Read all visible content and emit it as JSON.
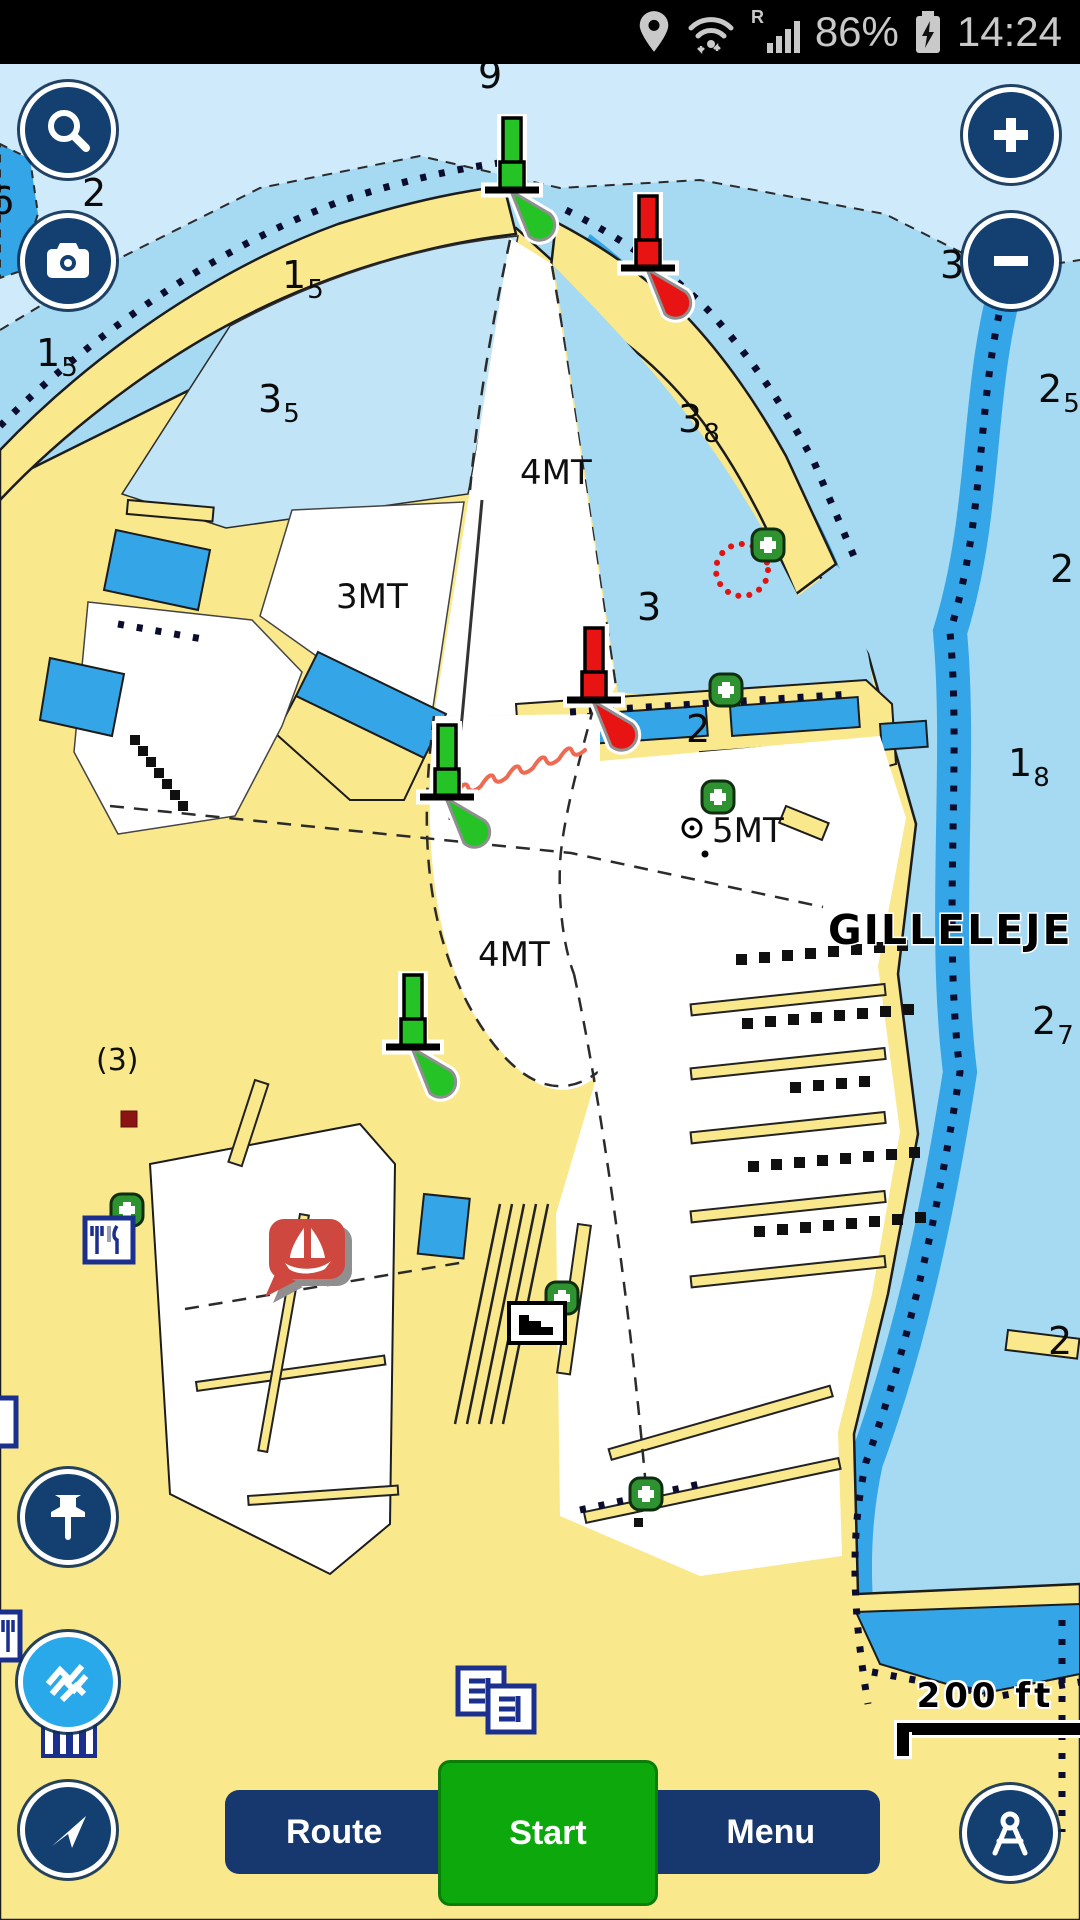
{
  "status_bar": {
    "time": "14:24",
    "battery": "86%",
    "roaming_badge": "R",
    "icons": {
      "location": "location-pin",
      "wifi": "wifi-arrows",
      "signal": "signal-bars",
      "battery": "battery-charging"
    }
  },
  "map_controls": {
    "icons": {
      "search": "magnifier",
      "camera": "camera",
      "zoom_in": "plus",
      "zoom_out": "minus",
      "drop_pin": "pushpin",
      "sonar_charts": "navionics-waves",
      "follow_me": "navigation-arrow",
      "distance_tool": "divider-compass"
    }
  },
  "bottom_bar": {
    "route_label": "Route",
    "start_label": "Start",
    "menu_label": "Menu"
  },
  "map": {
    "place_label": "GILLELEJE",
    "scale_label": "200 ft",
    "annotation": "(3)",
    "depth_area_labels": [
      {
        "text": "4MT",
        "x": 520,
        "y": 420
      },
      {
        "text": "3MT",
        "x": 336,
        "y": 544
      },
      {
        "text": "5MT",
        "x": 712,
        "y": 778
      },
      {
        "text": "4MT",
        "x": 478,
        "y": 902
      }
    ],
    "soundings": [
      {
        "main": "9",
        "sub": "",
        "x": 478,
        "y": 24
      },
      {
        "main": "6",
        "sub": "",
        "x": -10,
        "y": 150
      },
      {
        "main": "2",
        "sub": "",
        "x": 82,
        "y": 142
      },
      {
        "main": "1",
        "sub": "5",
        "x": 36,
        "y": 302
      },
      {
        "main": "1",
        "sub": "5",
        "x": 282,
        "y": 224
      },
      {
        "main": "3",
        "sub": "5",
        "x": 258,
        "y": 348
      },
      {
        "main": "3",
        "sub": "8",
        "x": 678,
        "y": 368
      },
      {
        "main": "2",
        "sub": "5",
        "x": 1038,
        "y": 338
      },
      {
        "main": "3",
        "sub": "",
        "x": 940,
        "y": 214
      },
      {
        "main": "2",
        "sub": "",
        "x": 1050,
        "y": 518
      },
      {
        "main": "3",
        "sub": "",
        "x": 637,
        "y": 556
      },
      {
        "main": "1",
        "sub": "8",
        "x": 1008,
        "y": 712
      },
      {
        "main": "2",
        "sub": "",
        "x": 686,
        "y": 678
      },
      {
        "main": "2",
        "sub": "7",
        "x": 1032,
        "y": 970
      },
      {
        "main": "2",
        "sub": "",
        "x": 1048,
        "y": 1290
      }
    ],
    "colors": {
      "land": "#fae88c",
      "sea_light": "#cfeafa",
      "sea_medium": "#a6d9f2",
      "sea_deep": "#34a5e6",
      "navy": "#134071",
      "start_green": "#0ca80c",
      "beacon_green": "#25c325",
      "beacon_red": "#e81414",
      "balloon_red": "#cf4840",
      "plus_marker_green": "#2e9230",
      "waves_blue": "#2aa9ea"
    }
  }
}
